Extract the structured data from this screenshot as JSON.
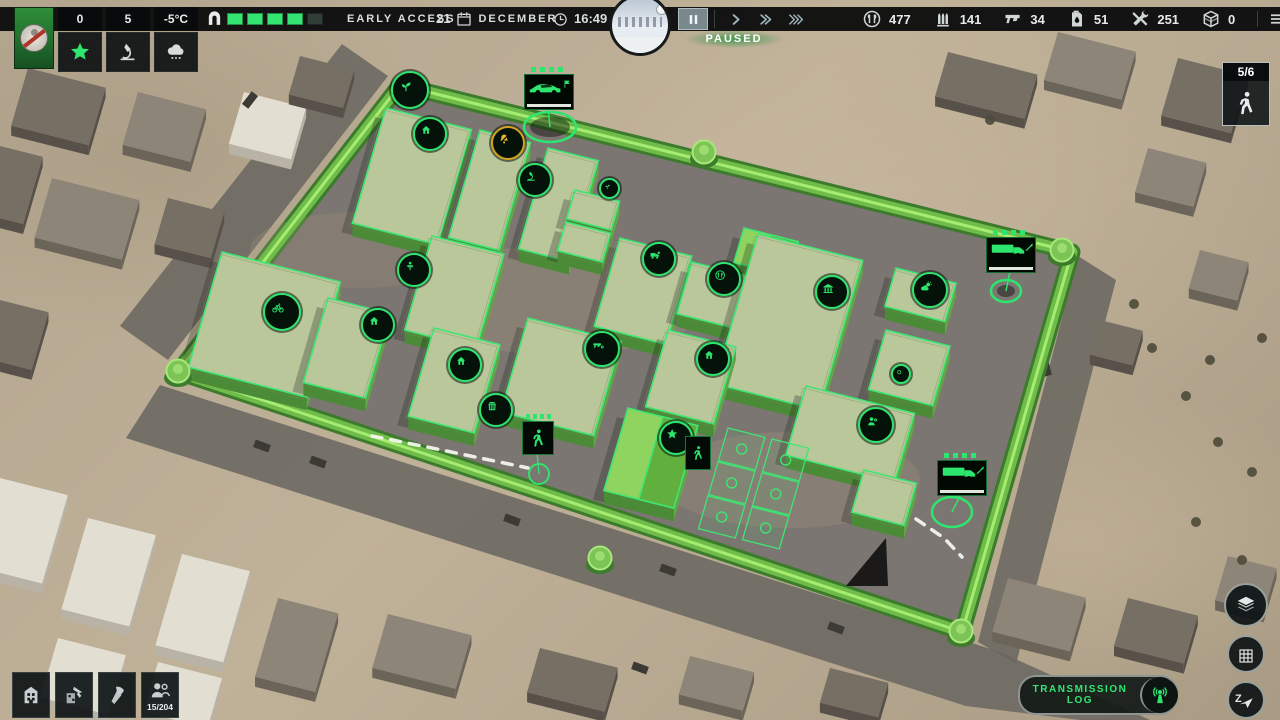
{
  "colors": {
    "accent": "#2ee56e",
    "gold": "#d8a31c",
    "wall": "#6fbc4a",
    "wall_dark": "#3c7a2c",
    "wall_light": "#a5ec70",
    "building_top": "#b9c79b",
    "building_side_l": "#4b8a37",
    "building_side_r": "#61a647",
    "courtyard": "#7b7671"
  },
  "top_bar": {
    "faction": {
      "emblem": "wolf-no-entry-emblem"
    },
    "stats": [
      {
        "name": "reputation",
        "value": "0",
        "icon": "star"
      },
      {
        "name": "research",
        "value": "5",
        "icon": "microscope"
      },
      {
        "name": "weather",
        "value": "-5°C",
        "icon": "snow-cloud"
      }
    ],
    "gate": {
      "icon": "gate",
      "segments": 5,
      "filled": 4
    },
    "edition_label": "EARLY ACCESS",
    "date": {
      "day": "21",
      "icon": "calendar",
      "month": "DECEMBER"
    },
    "time": {
      "icon": "clock",
      "value": "16:49"
    },
    "speed_controls": {
      "paused_label": "PAUSED",
      "buttons": [
        {
          "name": "pause",
          "icon": "pause",
          "active": true
        },
        {
          "name": "play",
          "icon": "play",
          "active": false
        },
        {
          "name": "fast-forward",
          "icon": "ff",
          "active": false
        },
        {
          "name": "fastest-forward",
          "icon": "fff",
          "active": false
        }
      ]
    },
    "resources": [
      {
        "name": "food",
        "icon": "food",
        "value": "477"
      },
      {
        "name": "ammo",
        "icon": "ammo",
        "value": "141"
      },
      {
        "name": "weapons",
        "icon": "pistol",
        "value": "34"
      },
      {
        "name": "fuel",
        "icon": "fuel",
        "value": "51"
      },
      {
        "name": "tools",
        "icon": "tools",
        "value": "251"
      },
      {
        "name": "materials",
        "icon": "box",
        "value": "0"
      }
    ],
    "menu_icon": "menu"
  },
  "squads_panel": {
    "count": "5/6",
    "icon": "walk"
  },
  "bottom_left_toolbar": [
    {
      "name": "buildings",
      "icon": "buildings",
      "badge": ""
    },
    {
      "name": "construction",
      "icon": "construct",
      "badge": ""
    },
    {
      "name": "demolish",
      "icon": "axe",
      "badge": ""
    },
    {
      "name": "population",
      "icon": "people",
      "badge": "15/204"
    }
  ],
  "bottom_right": {
    "transmission_log": {
      "label": "TRANSMISSION LOG",
      "icon": "radio"
    },
    "map_buttons": [
      {
        "name": "layers",
        "icon": "layers",
        "letter": ""
      },
      {
        "name": "grid",
        "icon": "grid",
        "letter": ""
      },
      {
        "name": "compass",
        "icon": "compass",
        "letter": "Z"
      }
    ]
  },
  "map": {
    "wall": [
      [
        400,
        85
      ],
      [
        1072,
        252
      ],
      [
        962,
        632
      ],
      [
        178,
        372
      ]
    ],
    "towers": [
      [
        408,
        88
      ],
      [
        704,
        152
      ],
      [
        1062,
        250
      ],
      [
        178,
        371
      ],
      [
        961,
        631
      ],
      [
        600,
        558
      ]
    ],
    "buildings": [
      {
        "p": [
          386,
          108
        ],
        "du": 88,
        "dv": 120
      },
      {
        "p": [
          480,
          130
        ],
        "du": 52,
        "dv": 112
      },
      {
        "p": [
          548,
          148
        ],
        "du": 52,
        "dv": 105
      },
      {
        "p": [
          575,
          190
        ],
        "du": 46,
        "dv": 30
      },
      {
        "p": [
          566,
          222
        ],
        "du": 46,
        "dv": 30
      },
      {
        "p": [
          744,
          228
        ],
        "du": 56,
        "dv": 36,
        "tent": true
      },
      {
        "p": [
          222,
          252
        ],
        "du": 122,
        "dv": 120
      },
      {
        "p": [
          432,
          236
        ],
        "du": 74,
        "dv": 98
      },
      {
        "p": [
          328,
          298
        ],
        "du": 64,
        "dv": 88
      },
      {
        "p": [
          434,
          328
        ],
        "du": 68,
        "dv": 92
      },
      {
        "p": [
          620,
          238
        ],
        "du": 74,
        "dv": 92
      },
      {
        "p": [
          692,
          262
        ],
        "du": 62,
        "dv": 54
      },
      {
        "p": [
          758,
          234
        ],
        "du": 108,
        "dv": 156
      },
      {
        "p": [
          896,
          268
        ],
        "du": 62,
        "dv": 40
      },
      {
        "p": [
          886,
          330
        ],
        "du": 66,
        "dv": 62
      },
      {
        "p": [
          528,
          318
        ],
        "du": 96,
        "dv": 98
      },
      {
        "p": [
          668,
          330
        ],
        "du": 70,
        "dv": 80
      },
      {
        "p": [
          628,
          408
        ],
        "du": 72,
        "dv": 86,
        "tent": true
      },
      {
        "p": [
          806,
          386
        ],
        "du": 112,
        "dv": 72
      },
      {
        "p": [
          864,
          470
        ],
        "du": 54,
        "dv": 44
      }
    ],
    "plots": [
      {
        "p": [
          728,
          428
        ],
        "du": 38,
        "dv": 34
      },
      {
        "p": [
          772,
          439
        ],
        "du": 38,
        "dv": 34
      },
      {
        "p": [
          718,
          462
        ],
        "du": 38,
        "dv": 34
      },
      {
        "p": [
          762,
          473
        ],
        "du": 38,
        "dv": 34
      },
      {
        "p": [
          708,
          496
        ],
        "du": 38,
        "dv": 34
      },
      {
        "p": [
          752,
          507
        ],
        "du": 38,
        "dv": 34
      }
    ],
    "badges": [
      {
        "at": [
          408,
          88
        ],
        "icon": "sprout",
        "size": 34,
        "name": "watchtower-growing-badge"
      },
      {
        "at": [
          428,
          132
        ],
        "icon": "house",
        "size": 30,
        "name": "shelter-badge"
      },
      {
        "at": [
          506,
          141
        ],
        "icon": "bell-muted",
        "size": 30,
        "gold": true,
        "name": "alarm-muted-badge"
      },
      {
        "at": [
          533,
          178
        ],
        "icon": "microscope",
        "size": 30,
        "name": "laboratory-badge"
      },
      {
        "at": [
          607,
          186
        ],
        "icon": "sprout",
        "size": 17,
        "name": "small-plant-badge"
      },
      {
        "at": [
          657,
          257
        ],
        "icon": "vehicle-gear",
        "size": 30,
        "name": "garage-badge"
      },
      {
        "at": [
          722,
          277
        ],
        "icon": "canteen",
        "size": 30,
        "name": "canteen-badge"
      },
      {
        "at": [
          830,
          290
        ],
        "icon": "warehouse",
        "size": 30,
        "name": "warehouse-badge"
      },
      {
        "at": [
          928,
          288
        ],
        "icon": "sun-cloud",
        "size": 32,
        "name": "weather-station-badge"
      },
      {
        "at": [
          280,
          310
        ],
        "icon": "bike",
        "size": 34,
        "name": "workshop-badge"
      },
      {
        "at": [
          412,
          268
        ],
        "icon": "lectern",
        "size": 30,
        "name": "school-badge"
      },
      {
        "at": [
          376,
          323
        ],
        "icon": "house",
        "size": 30,
        "name": "shelter-badge"
      },
      {
        "at": [
          463,
          363
        ],
        "icon": "house",
        "size": 30,
        "name": "shelter-badge"
      },
      {
        "at": [
          494,
          408
        ],
        "icon": "storage",
        "size": 30,
        "name": "storage-badge"
      },
      {
        "at": [
          600,
          347
        ],
        "icon": "pistol-gear",
        "size": 32,
        "name": "weapon-workshop-badge"
      },
      {
        "at": [
          711,
          357
        ],
        "icon": "house",
        "size": 30,
        "name": "shelter-badge"
      },
      {
        "at": [
          874,
          423
        ],
        "icon": "person-gear",
        "size": 32,
        "name": "crew-badge"
      },
      {
        "at": [
          899,
          372
        ],
        "icon": "dot",
        "size": 16,
        "name": "small-marker-badge"
      },
      {
        "at": [
          674,
          436
        ],
        "icon": "star",
        "size": 30,
        "name": "headquarters-badge"
      }
    ],
    "vehicles": [
      {
        "panel": [
          548,
          91
        ],
        "glyph": "car",
        "corner": "flag",
        "target": [
          550,
          127
        ],
        "rx": 26,
        "ry": 15,
        "blob": true,
        "name": "car-marker"
      },
      {
        "panel": [
          1010,
          254
        ],
        "glyph": "truckart",
        "corner": "knife",
        "target": [
          1006,
          291
        ],
        "rx": 15,
        "ry": 11,
        "blob": true,
        "name": "truck-marker"
      },
      {
        "panel": [
          961,
          477
        ],
        "glyph": "truckart",
        "corner": "knife",
        "target": [
          952,
          512
        ],
        "rx": 20,
        "ry": 15,
        "blob": false,
        "name": "truck-marker"
      }
    ],
    "squad": {
      "panel": [
        537,
        437
      ],
      "target": [
        539,
        474
      ]
    },
    "hq_panel": {
      "at": [
        697,
        452
      ]
    },
    "paths": [
      [
        [
          372,
          436
        ],
        [
          432,
          448
        ],
        [
          528,
          468
        ]
      ],
      [
        [
          916,
          519
        ],
        [
          944,
          538
        ],
        [
          962,
          557
        ]
      ]
    ],
    "roads": [
      [
        [
          160,
          385
        ],
        [
          1000,
          652
        ],
        [
          966,
          706
        ],
        [
          126,
          438
        ]
      ],
      [
        [
          388,
          76
        ],
        [
          168,
          360
        ],
        [
          120,
          326
        ],
        [
          342,
          44
        ]
      ],
      [
        [
          1078,
          256
        ],
        [
          978,
          642
        ],
        [
          1016,
          664
        ],
        [
          1116,
          280
        ]
      ],
      [
        [
          1000,
          652
        ],
        [
          1150,
          720
        ],
        [
          1080,
          720
        ],
        [
          966,
          706
        ]
      ]
    ],
    "outside": [
      {
        "p": [
          28,
          68
        ],
        "du": 80,
        "dv": 60,
        "c": "dark"
      },
      {
        "p": [
          138,
          92
        ],
        "du": 70,
        "dv": 55,
        "c": "mid"
      },
      {
        "p": [
          52,
          178
        ],
        "du": 90,
        "dv": 62,
        "c": "mid"
      },
      {
        "p": [
          168,
          198
        ],
        "du": 58,
        "dv": 48,
        "c": "dark"
      },
      {
        "p": [
          0,
          146
        ],
        "du": 44,
        "dv": 70,
        "c": "dark"
      },
      {
        "p": [
          244,
          92
        ],
        "du": 64,
        "dv": 54,
        "c": "white"
      },
      {
        "p": [
          300,
          56
        ],
        "du": 56,
        "dv": 40,
        "c": "dark"
      },
      {
        "p": [
          948,
          52
        ],
        "du": 92,
        "dv": 46,
        "c": "dark"
      },
      {
        "p": [
          1058,
          32
        ],
        "du": 80,
        "dv": 50,
        "c": "mid"
      },
      {
        "p": [
          1178,
          58
        ],
        "du": 72,
        "dv": 60,
        "c": "dark"
      },
      {
        "p": [
          1148,
          148
        ],
        "du": 60,
        "dv": 46,
        "c": "mid"
      },
      {
        "p": [
          1200,
          250
        ],
        "du": 50,
        "dv": 40,
        "c": "mid"
      },
      {
        "p": [
          1100,
          320
        ],
        "du": 44,
        "dv": 36,
        "c": "dark"
      },
      {
        "p": [
          1008,
          578
        ],
        "du": 80,
        "dv": 56,
        "c": "mid"
      },
      {
        "p": [
          1128,
          598
        ],
        "du": 72,
        "dv": 50,
        "c": "dark"
      },
      {
        "p": [
          1228,
          556
        ],
        "du": 50,
        "dv": 46,
        "c": "mid"
      },
      {
        "p": [
          0,
          300
        ],
        "du": 50,
        "dv": 60,
        "c": "dark"
      },
      {
        "p": [
          0,
          478
        ],
        "du": 70,
        "dv": 92,
        "c": "white"
      },
      {
        "p": [
          88,
          518
        ],
        "du": 70,
        "dv": 95,
        "c": "white"
      },
      {
        "p": [
          182,
          554
        ],
        "du": 70,
        "dv": 95,
        "c": "white"
      },
      {
        "p": [
          58,
          638
        ],
        "du": 70,
        "dv": 62,
        "c": "white"
      },
      {
        "p": [
          158,
          662
        ],
        "du": 66,
        "dv": 52,
        "c": "white"
      },
      {
        "p": [
          278,
          598
        ],
        "du": 62,
        "dv": 82,
        "c": "mid"
      },
      {
        "p": [
          388,
          614
        ],
        "du": 86,
        "dv": 56,
        "c": "mid"
      },
      {
        "p": [
          540,
          648
        ],
        "du": 80,
        "dv": 46,
        "c": "dark"
      },
      {
        "p": [
          690,
          656
        ],
        "du": 66,
        "dv": 40,
        "c": "mid"
      },
      {
        "p": [
          830,
          668
        ],
        "du": 60,
        "dv": 36,
        "c": "dark"
      }
    ],
    "cars": [
      [
        262,
        446,
        20
      ],
      [
        318,
        462,
        20
      ],
      [
        512,
        520,
        20
      ],
      [
        668,
        570,
        20
      ],
      [
        836,
        628,
        20
      ],
      [
        1022,
        312,
        75
      ],
      [
        1046,
        368,
        75
      ],
      [
        250,
        100,
        -52
      ],
      [
        640,
        668,
        20
      ]
    ],
    "trees": [
      [
        1152,
        348
      ],
      [
        1186,
        396
      ],
      [
        1218,
        442
      ],
      [
        1252,
        472
      ],
      [
        1134,
        304
      ],
      [
        1262,
        338
      ],
      [
        1196,
        522
      ],
      [
        1242,
        560
      ],
      [
        990,
        120
      ],
      [
        1210,
        360
      ]
    ],
    "debris": [
      [
        846,
        586
      ],
      [
        886,
        538
      ],
      [
        888,
        586
      ]
    ]
  }
}
